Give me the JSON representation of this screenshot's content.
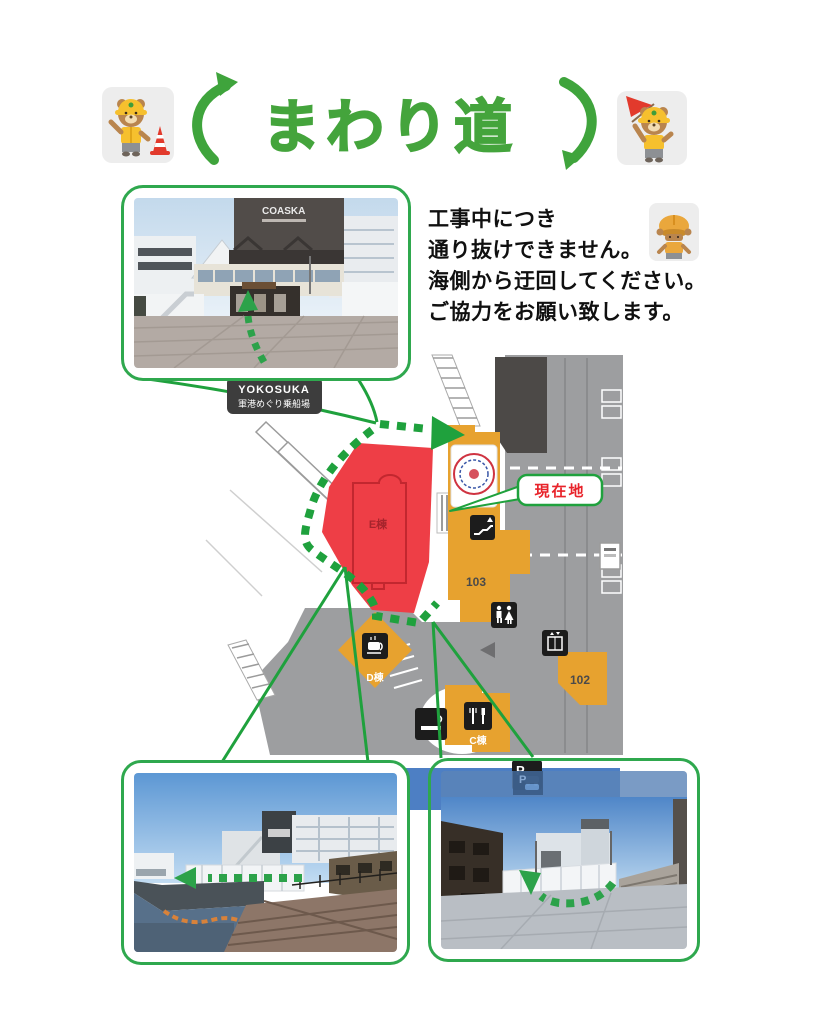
{
  "title": "まわり道",
  "title_mascots": {
    "left": "worker-bear-with-traffic-cone",
    "right": "worker-bear-with-red-flag"
  },
  "notice": {
    "lines": [
      "工事中につき",
      "通り抜けできません。",
      "海側から迂回してください。",
      "ご協力をお願い致します。"
    ],
    "mascot": "bowing-worker-bear"
  },
  "map": {
    "boarding_label": {
      "en": "YOKOSUKA",
      "jp": "軍港めぐり乗船場"
    },
    "current_location_label": "現在地",
    "buildings": {
      "e_wing": "E棟",
      "d_wing": "D棟",
      "c_wing": "C棟",
      "no_103": "103",
      "no_102": "102"
    },
    "icons": [
      "escalator-icon",
      "restroom-icon",
      "coffee-icon",
      "restaurant-icon",
      "smoking-area-icon",
      "elevator-icon",
      "parking-icon",
      "info-sign-icon",
      "emblem-crest-icon"
    ],
    "colors": {
      "accent_green": "#1fa13d",
      "closed_area_red": "#ee3e46",
      "building_orange": "#e7a22f",
      "dark_building": "#4c4947",
      "road_gray": "#9d9ea0",
      "water_blue": "#4d7fc4",
      "label_red": "#e8232a",
      "label_box_dark": "#3d3d3d"
    }
  },
  "photos": {
    "top": "coaska-entrance-blocked-path-photo",
    "bottom_left": "seaside-detour-walkway-photo",
    "bottom_right": "plaza-detour-route-photo"
  }
}
